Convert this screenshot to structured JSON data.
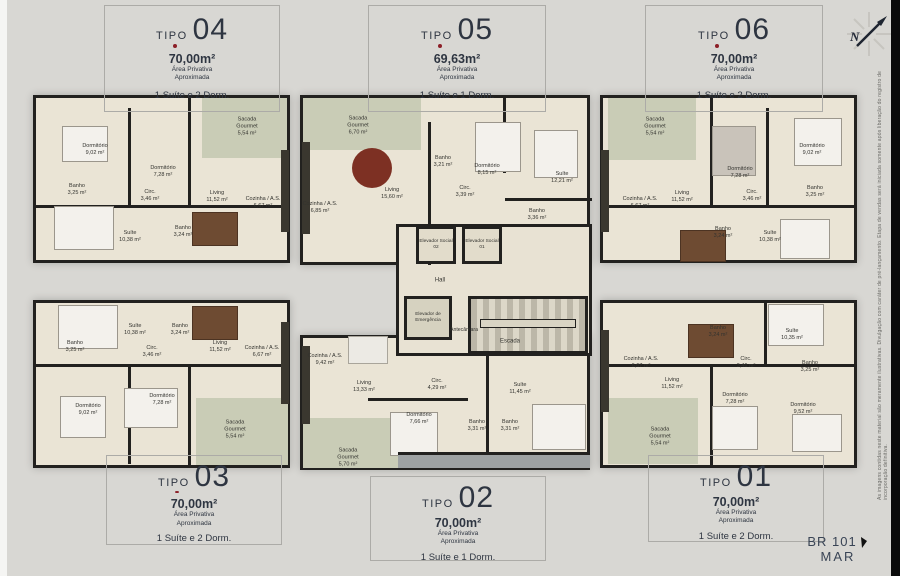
{
  "boxes": [
    {
      "prefix": "TIPO",
      "number": "04",
      "area": "70,00m²",
      "note1": "Área Privativa",
      "note2": "Aproximada",
      "desc": "1 Suíte e 2 Dorm."
    },
    {
      "prefix": "TIPO",
      "number": "05",
      "area": "69,63m²",
      "note1": "Área Privativa",
      "note2": "Aproximada",
      "desc": "1 Suíte e 1 Dorm."
    },
    {
      "prefix": "TIPO",
      "number": "06",
      "area": "70,00m²",
      "note1": "Área Privativa",
      "note2": "Aproximada",
      "desc": "1 Suíte e 2 Dorm."
    },
    {
      "prefix": "TIPO",
      "number": "03",
      "area": "70,00m²",
      "note1": "Área Privativa",
      "note2": "Aproximada",
      "desc": "1 Suíte e 2 Dorm."
    },
    {
      "prefix": "TIPO",
      "number": "02",
      "area": "70,00m²",
      "note1": "Área Privativa",
      "note2": "Aproximada",
      "desc": "1 Suíte e 1 Dorm."
    },
    {
      "prefix": "TIPO",
      "number": "01",
      "area": "70,00m²",
      "note1": "Área Privativa",
      "note2": "Aproximada",
      "desc": "1 Suíte e 2 Dorm."
    }
  ],
  "units": {
    "t04": {
      "rooms": [
        {
          "n": "Dormitório",
          "a": "9,02 m²"
        },
        {
          "n": "Dormitório",
          "a": "7,28 m²"
        },
        {
          "n": "Sacada Gourmet",
          "a": "5,54 m²"
        },
        {
          "n": "Banho",
          "a": "3,25 m²"
        },
        {
          "n": "Circ.",
          "a": "3,46 m²"
        },
        {
          "n": "Living",
          "a": "11,52 m²"
        },
        {
          "n": "Cozinha / A.S.",
          "a": "6,67 m²"
        },
        {
          "n": "Suíte",
          "a": "10,38 m²"
        },
        {
          "n": "Banho",
          "a": "3,24 m²"
        }
      ]
    },
    "t05": {
      "rooms": [
        {
          "n": "Sacada Gourmet",
          "a": "6,70 m²"
        },
        {
          "n": "Cozinha / A.S.",
          "a": "6,85 m²"
        },
        {
          "n": "Living",
          "a": "15,60 m²"
        },
        {
          "n": "Banho",
          "a": "3,21 m²"
        },
        {
          "n": "Circ.",
          "a": "3,39 m²"
        },
        {
          "n": "Dormitório",
          "a": "8,15 m²"
        },
        {
          "n": "Suíte",
          "a": "12,21 m²"
        },
        {
          "n": "Banho",
          "a": "3,36 m²"
        }
      ]
    },
    "t06": {
      "rooms": [
        {
          "n": "Sacada Gourmet",
          "a": "5,54 m²"
        },
        {
          "n": "Cozinha / A.S.",
          "a": "6,67 m²"
        },
        {
          "n": "Living",
          "a": "11,52 m²"
        },
        {
          "n": "Dormitório",
          "a": "7,28 m²"
        },
        {
          "n": "Dormitório",
          "a": "9,02 m²"
        },
        {
          "n": "Circ.",
          "a": "3,46 m²"
        },
        {
          "n": "Banho",
          "a": "3,25 m²"
        },
        {
          "n": "Banho",
          "a": "3,24 m²"
        },
        {
          "n": "Suíte",
          "a": "10,38 m²"
        }
      ]
    },
    "t03": {
      "rooms": [
        {
          "n": "Suíte",
          "a": "10,38 m²"
        },
        {
          "n": "Banho",
          "a": "3,24 m²"
        },
        {
          "n": "Banho",
          "a": "3,25 m²"
        },
        {
          "n": "Circ.",
          "a": "3,46 m²"
        },
        {
          "n": "Living",
          "a": "11,52 m²"
        },
        {
          "n": "Cozinha / A.S.",
          "a": "6,67 m²"
        },
        {
          "n": "Dormitório",
          "a": "7,28 m²"
        },
        {
          "n": "Dormitório",
          "a": "9,02 m²"
        },
        {
          "n": "Sacada Gourmet",
          "a": "5,54 m²"
        }
      ]
    },
    "t02": {
      "rooms": [
        {
          "n": "Cozinha / A.S.",
          "a": "9,42 m²"
        },
        {
          "n": "Living",
          "a": "13,33 m²"
        },
        {
          "n": "Circ.",
          "a": "4,29 m²"
        },
        {
          "n": "Dormitório",
          "a": "7,66 m²"
        },
        {
          "n": "Banho",
          "a": "3,31 m²"
        },
        {
          "n": "Banho",
          "a": "3,31 m²"
        },
        {
          "n": "Suíte",
          "a": "11,45 m²"
        },
        {
          "n": "Sacada Gourmet",
          "a": "5,70 m²"
        }
      ]
    },
    "t01": {
      "rooms": [
        {
          "n": "Cozinha / A.S.",
          "a": "6,67 m²"
        },
        {
          "n": "Living",
          "a": "11,52 m²"
        },
        {
          "n": "Circ.",
          "a": "3,46 m²"
        },
        {
          "n": "Banho",
          "a": "3,24 m²"
        },
        {
          "n": "Suíte",
          "a": "10,35 m²"
        },
        {
          "n": "Banho",
          "a": "3,25 m²"
        },
        {
          "n": "Dormitório",
          "a": "7,28 m²"
        },
        {
          "n": "Dormitório",
          "a": "9,52 m²"
        },
        {
          "n": "Sacada Gourmet",
          "a": "5,54 m²"
        }
      ]
    }
  },
  "core": {
    "hall": "Hall",
    "elev2": "Elevador Social 02",
    "elev1": "Elevador Social 01",
    "emerg": "Elevador de Emergência",
    "ante": "Antecâmara",
    "stairs": "Escada"
  },
  "compass_letter": "N",
  "road": {
    "line1": "BR 101",
    "line2": "MAR"
  },
  "disclaimer": "As imagens contidas neste material são meramente ilustrativas. Divulgação com caráter de pré-lançamento. Etapa de vendas será iniciada somente após liberação do registro de incorporação definitiva.",
  "colors": {
    "accent_dot": "#8c1f27",
    "walls": "#22211f",
    "text": "#2e3541",
    "floor": "#eae4d5",
    "balcony": "#c9ccb6"
  }
}
